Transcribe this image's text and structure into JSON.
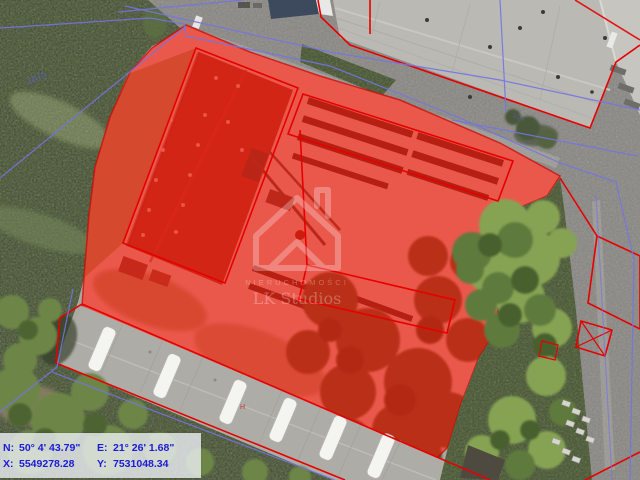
{
  "map": {
    "watermark": {
      "logo": "house-outline",
      "line1": "NIERUCHOMOŚCI",
      "line2": "LK Studios"
    },
    "labels": {
      "field_parcel": "1879",
      "road_parcel": "31.5",
      "building_mark": "H"
    },
    "colors": {
      "selection_fill": "#ff1505",
      "cadastral_red": "#e60000",
      "cadastral_blue": "#7474e4",
      "panel_text": "#1b1bd4"
    }
  },
  "coordinate_panel": {
    "n_label": "N:",
    "n_value": "50° 4' 43.79\"",
    "e_label": "E:",
    "e_value": "21° 26' 1.68\"",
    "x_label": "X:",
    "x_value": "5549278.28",
    "y_label": "Y:",
    "y_value": "7531048.34"
  }
}
